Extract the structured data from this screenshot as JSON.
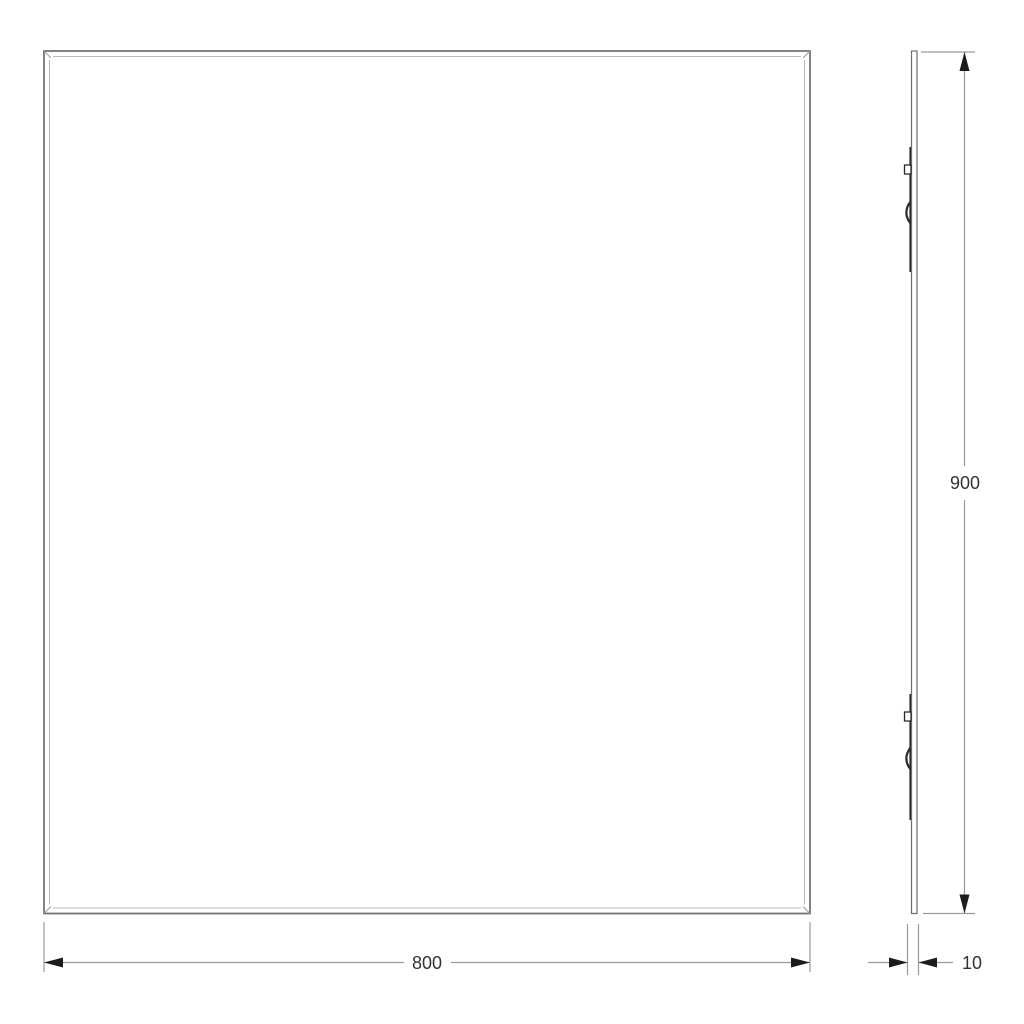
{
  "drawing": {
    "front_view": {
      "width_label": "800"
    },
    "side_view": {
      "height_label": "900",
      "depth_label": "10"
    }
  },
  "icons": {
    "dimension_arrow": "filled-triangle",
    "mounting_bracket": "rail-with-tab-and-clip"
  },
  "colors": {
    "background": "#ffffff",
    "outline": "#747474",
    "inner_edge": "#b9b9b9",
    "dimension_line": "#9a9a9a",
    "arrow": "#1c1c1c",
    "text": "#333333",
    "bracket": "#2b2b2b"
  }
}
